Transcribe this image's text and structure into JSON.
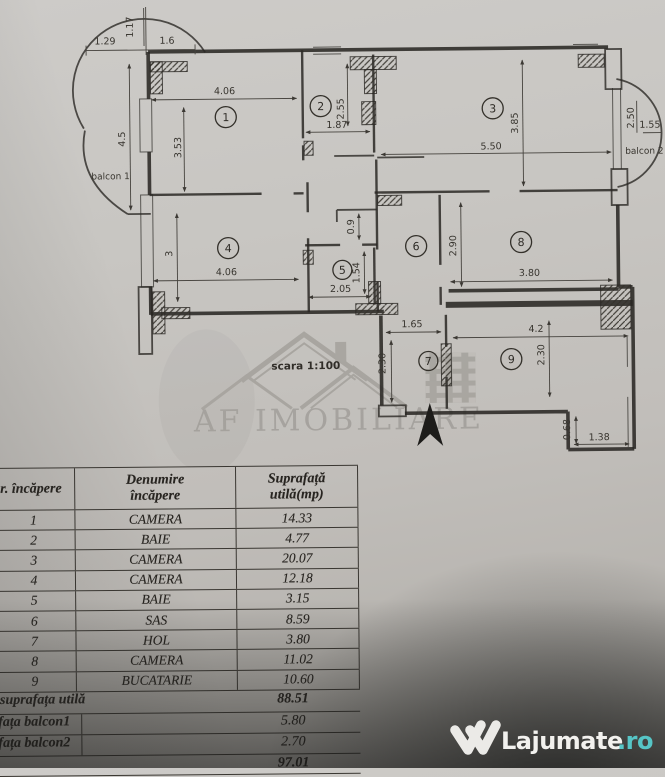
{
  "plan": {
    "scale_label": "scara 1:100",
    "balcony1_label": "balcon 1",
    "balcony2_label": "balcon 2",
    "watermark": "AF IMOBILIARE",
    "rooms": [
      "1",
      "2",
      "3",
      "4",
      "5",
      "6",
      "7",
      "8",
      "9"
    ],
    "dims": [
      "1.29",
      "1.6",
      "1.17",
      "4.5",
      "4.06",
      "3.53",
      "2.55",
      "1.87",
      "5.50",
      "3.85",
      "2.50",
      "1.55",
      "4.06",
      "3",
      "0.9",
      "2.05",
      "1.54",
      "2.90",
      "3.80",
      "1.65",
      "2.30",
      "4.2",
      "2.30",
      "0.68",
      "1.38"
    ]
  },
  "table": {
    "header": {
      "col1": "r. încăpere",
      "col2": [
        "Denumire",
        "încăpere"
      ],
      "col3": [
        "Suprafață",
        "utilă(mp)"
      ]
    },
    "rows": [
      [
        "1",
        "CAMERA",
        "14.33"
      ],
      [
        "2",
        "BAIE",
        "4.77"
      ],
      [
        "3",
        "CAMERA",
        "20.07"
      ],
      [
        "4",
        "CAMERA",
        "12.18"
      ],
      [
        "5",
        "BAIE",
        "3.15"
      ],
      [
        "6",
        "SAS",
        "8.59"
      ],
      [
        "7",
        "HOL",
        "3.80"
      ],
      [
        "8",
        "CAMERA",
        "11.02"
      ],
      [
        "9",
        "BUCATARIE",
        "10.60"
      ]
    ],
    "summary": [
      {
        "label": "suprafața utilă",
        "value": "88.51"
      },
      {
        "label": "fața balcon1",
        "value": "5.80"
      },
      {
        "label": "fața balcon2",
        "value": "2.70"
      },
      {
        "label": "",
        "value": "97.01"
      }
    ]
  },
  "footer": {
    "brand": "Lajumate",
    "tld": ".ro"
  },
  "colors": {
    "ink": "#2a2824",
    "paper": "#c6c3bf",
    "teal": "#56c5c6",
    "wm": "#8d8a84"
  }
}
